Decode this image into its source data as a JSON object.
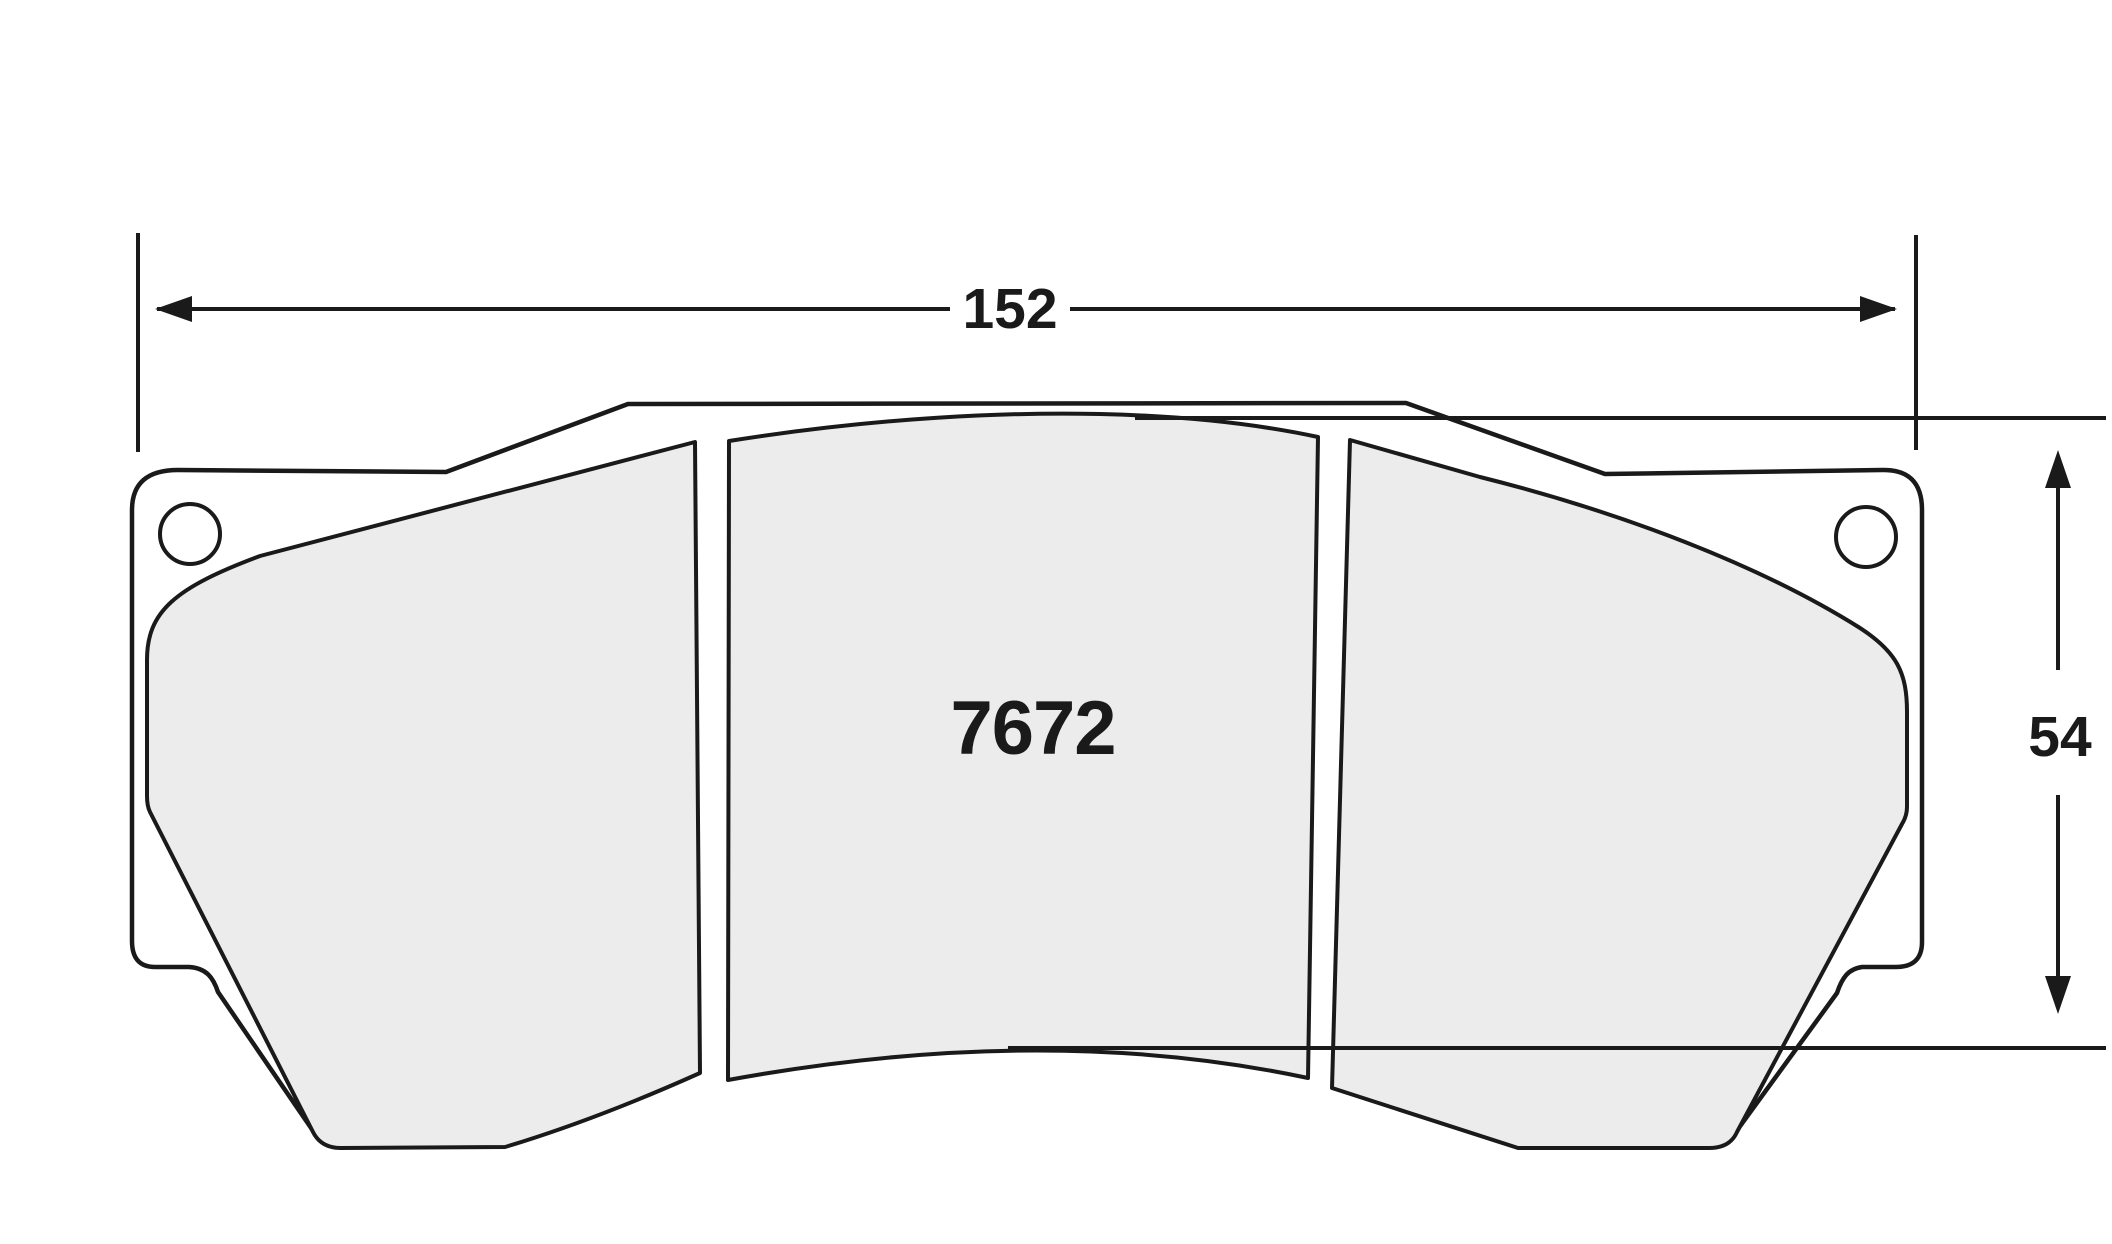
{
  "part": {
    "number": "7672"
  },
  "dimensions": {
    "width": "152",
    "height": "54"
  },
  "colors": {
    "line": "#1a1a1a",
    "pad_fill": "#ececec",
    "background": "#ffffff"
  }
}
